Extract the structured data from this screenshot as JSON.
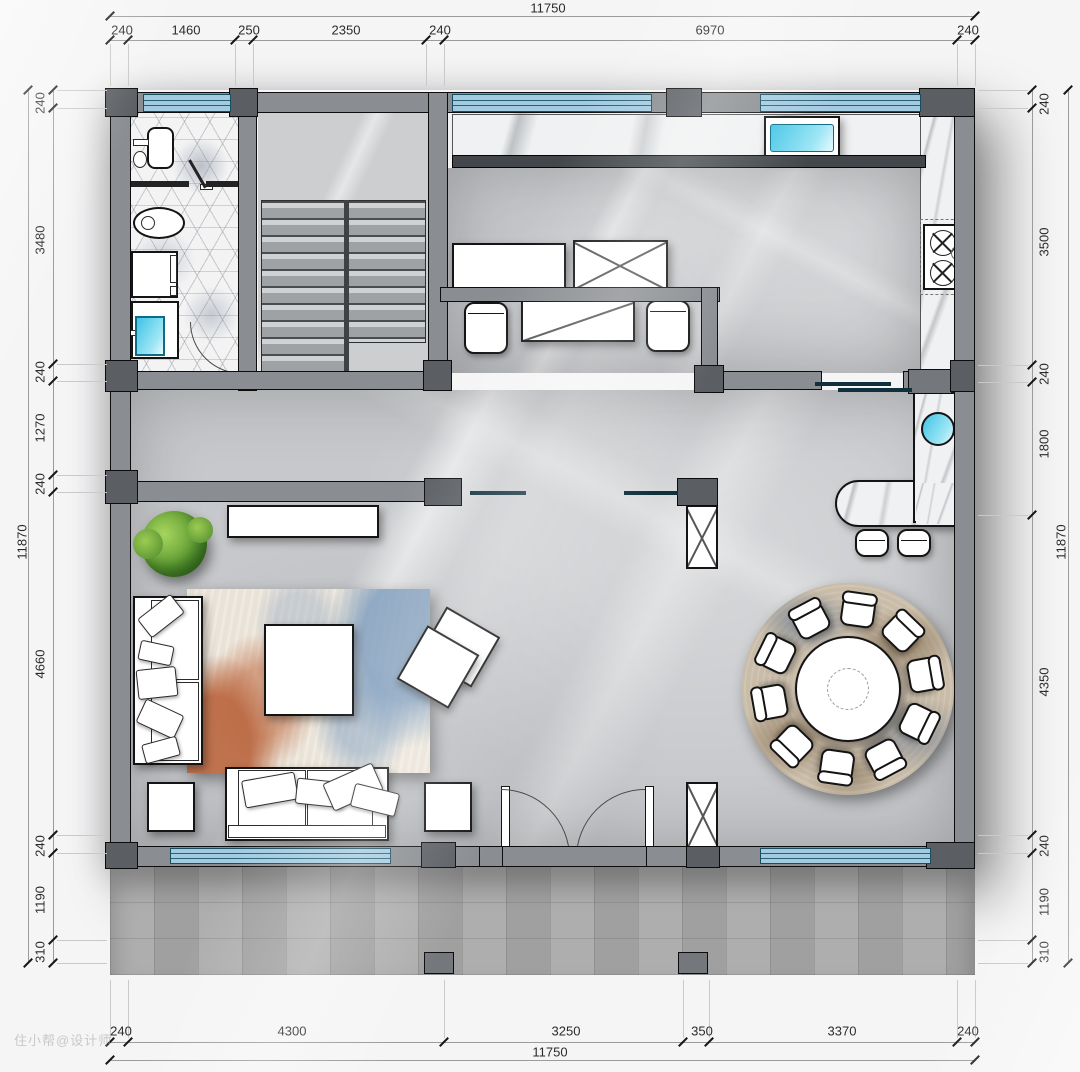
{
  "watermark": "住小帮@设计师",
  "dims": {
    "top": {
      "overall": "11750",
      "segs": [
        "240",
        "1460",
        "250",
        "2350",
        "240",
        "6970",
        "240"
      ]
    },
    "bottom": {
      "overall": "11750",
      "segs": [
        "240",
        "4300",
        "3250",
        "350",
        "3370",
        "240"
      ]
    },
    "left": {
      "overall": "11870",
      "segs": [
        "240",
        "3480",
        "240",
        "1270",
        "240",
        "4660",
        "240",
        "1190",
        "310"
      ]
    },
    "right": {
      "overall": "11870",
      "segs": [
        "240",
        "3500",
        "240",
        "1800",
        "4350",
        "240",
        "1190",
        "310"
      ]
    }
  },
  "colors": {
    "wall": "#8a8d91",
    "wall_dark": "#5b5f64",
    "window_blue": "#a3cbe0",
    "water_cyan": "#45c6e6",
    "floor_marble": "#c6c8cb",
    "rug_terracotta": "#bd7351",
    "rug_blue": "#7d9cbd",
    "plant_green": "#6aae3c",
    "patio_gray": "#a9a9a9"
  }
}
